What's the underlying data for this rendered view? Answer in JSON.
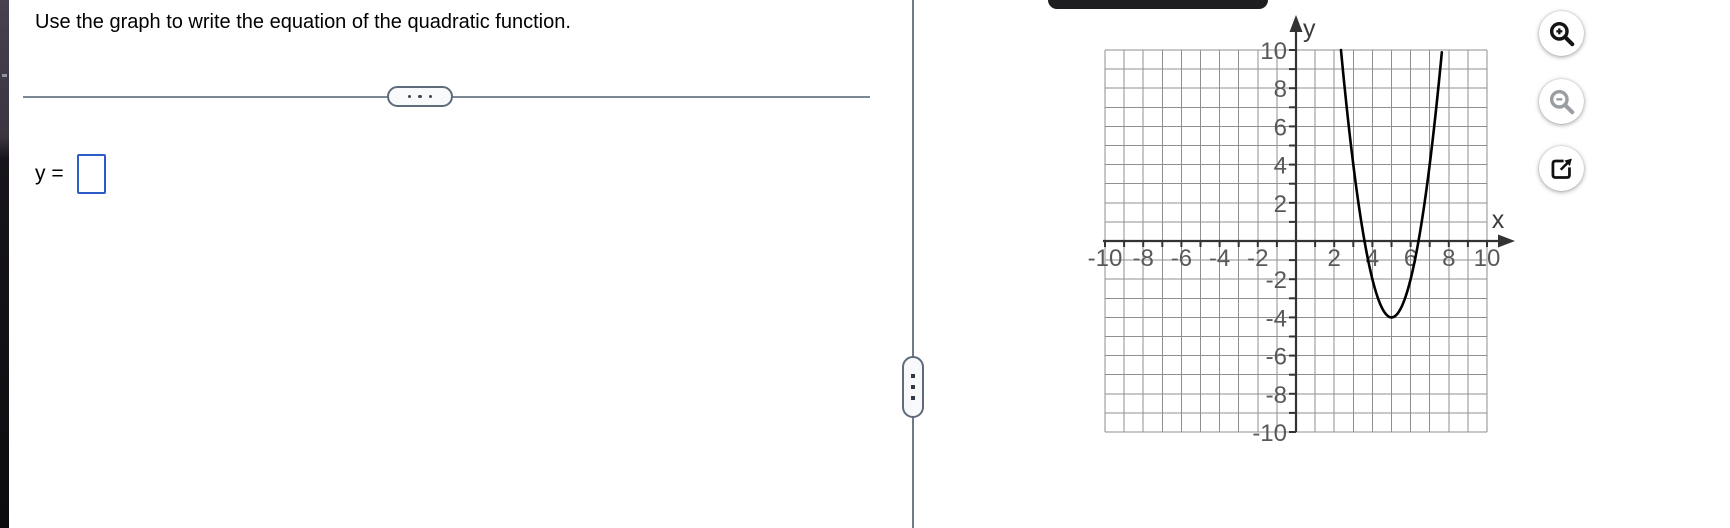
{
  "problem": {
    "title": "Use the graph to write the equation of the quadratic function.",
    "answer_prefix": "y =",
    "answer_value": ""
  },
  "dividers": {
    "horizontal_handle_icon": "ellipsis-dots-icon",
    "vertical_handle_icon": "vertical-ellipsis-dots-icon"
  },
  "graph_tools": {
    "zoom_in_icon": "magnifier-plus-icon",
    "zoom_out_icon": "magnifier-minus-icon",
    "open_icon": "open-in-new-window-icon",
    "zoom_in_color": "#141414",
    "zoom_out_color": "#9a9da1",
    "open_color": "#111111"
  },
  "chart_data": {
    "type": "line",
    "subtype": "quadratic-function-graph",
    "title": "",
    "function": {
      "equation": "y = 2(x - 5)^2 - 4",
      "form": "vertex",
      "a": 2,
      "h": 5,
      "k": -4,
      "vertex": [
        5,
        -4
      ],
      "x_intercepts_approx": [
        3.59,
        6.41
      ],
      "opens": "up"
    },
    "x_range": [
      -10,
      10
    ],
    "y_range": [
      -10,
      10
    ],
    "grid": true,
    "grid_step": 1,
    "x_tick_values": [
      -10,
      -8,
      -6,
      -4,
      -2,
      2,
      4,
      6,
      8,
      10
    ],
    "x_tick_labels": [
      "-10",
      "-8",
      "-6",
      "-4",
      "-2",
      "2",
      "4",
      "6",
      "8",
      "10"
    ],
    "y_tick_values": [
      10,
      8,
      6,
      4,
      2,
      -2,
      -4,
      -6,
      -8,
      -10
    ],
    "y_tick_labels": [
      "10",
      "8",
      "6",
      "4",
      "2",
      "-2",
      "-4",
      "-6",
      "-8",
      "-10"
    ],
    "x_axis_label": "x",
    "y_axis_label": "y",
    "curve_color": "#000000",
    "grid_color": "#8f8f8f",
    "axis_color": "#333333",
    "axis_label_color": "#3c3c3c",
    "tick_label_color": "#58595b",
    "curve_x_domain": [
      2.3542,
      7.6458
    ]
  }
}
